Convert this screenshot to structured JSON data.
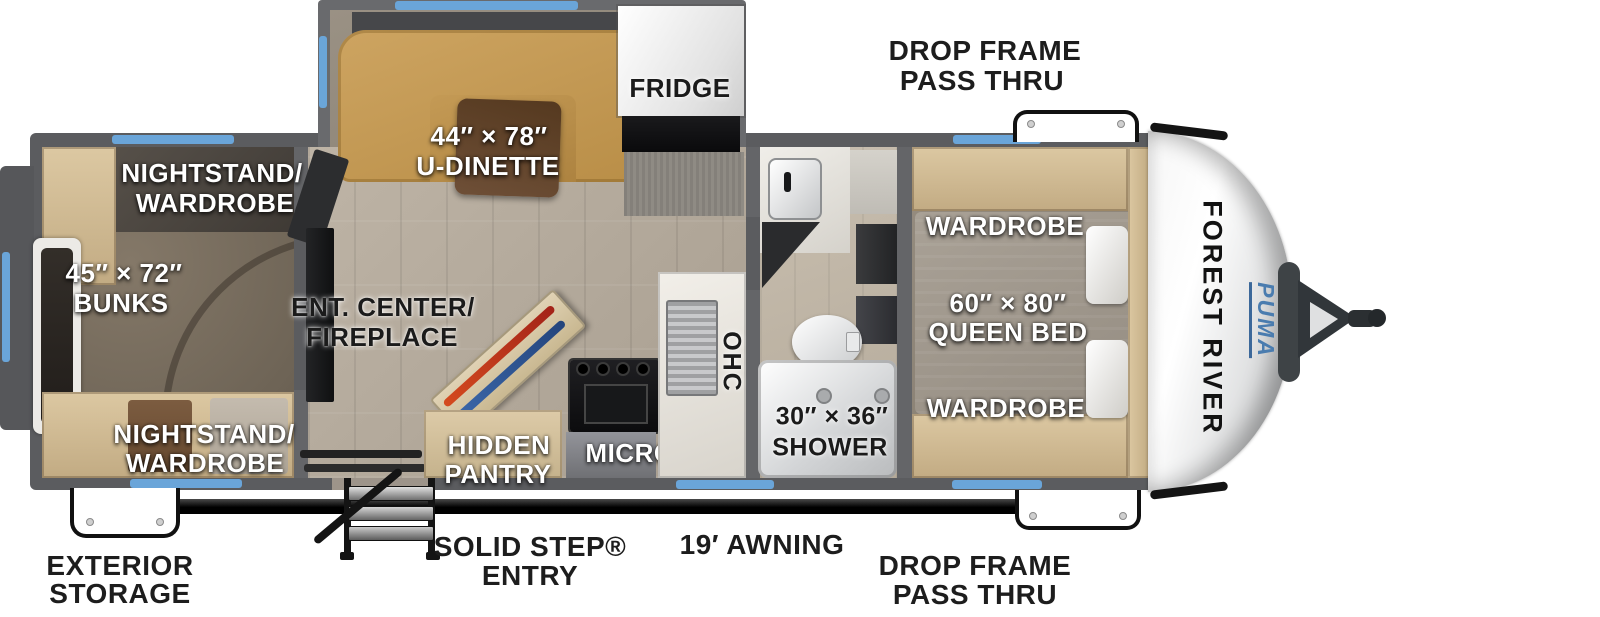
{
  "plan": {
    "slide": {
      "dinette_l1": "44″ × 78″",
      "dinette_l2": "U-DINETTE",
      "fridge": "FRIDGE"
    },
    "bunk_room": {
      "nightstand_top_l1": "NIGHTSTAND/",
      "nightstand_top_l2": "WARDROBE",
      "bunks_l1": "45″ × 72″",
      "bunks_l2": "BUNKS",
      "nightstand_bottom_l1": "NIGHTSTAND/",
      "nightstand_bottom_l2": "WARDROBE"
    },
    "living": {
      "ent_l1": "ENT. CENTER/",
      "ent_l2": "FIREPLACE",
      "pantry_l1": "HIDDEN",
      "pantry_l2": "PANTRY",
      "micro": "MICRO",
      "ohc": "OHC"
    },
    "bath": {
      "shower_l1": "30″ × 36″",
      "shower_l2": "SHOWER"
    },
    "bedroom": {
      "wardrobe_top": "WARDROBE",
      "bed_l1": "60″ × 80″",
      "bed_l2": "QUEEN BED",
      "wardrobe_bottom": "WARDROBE",
      "ohc": "OHC"
    },
    "brand": {
      "maker": "FOREST RIVER",
      "model": "PUMA"
    }
  },
  "exterior": {
    "drop_frame_top_l1": "DROP FRAME",
    "drop_frame_top_l2": "PASS THRU",
    "drop_frame_bottom_l1": "DROP FRAME",
    "drop_frame_bottom_l2": "PASS THRU",
    "exterior_storage_l1": "EXTERIOR",
    "exterior_storage_l2": "STORAGE",
    "solid_step_l1": "SOLID STEP®",
    "solid_step_l2": "ENTRY",
    "awning": "19′ AWNING"
  },
  "colors": {
    "wall": "#5b5c5f",
    "window": "#6aa5d9",
    "dinette": "#c59c58",
    "brand_blue": "#4a7caf",
    "label_white": "#ffffff",
    "label_black": "#1b1b1b"
  }
}
